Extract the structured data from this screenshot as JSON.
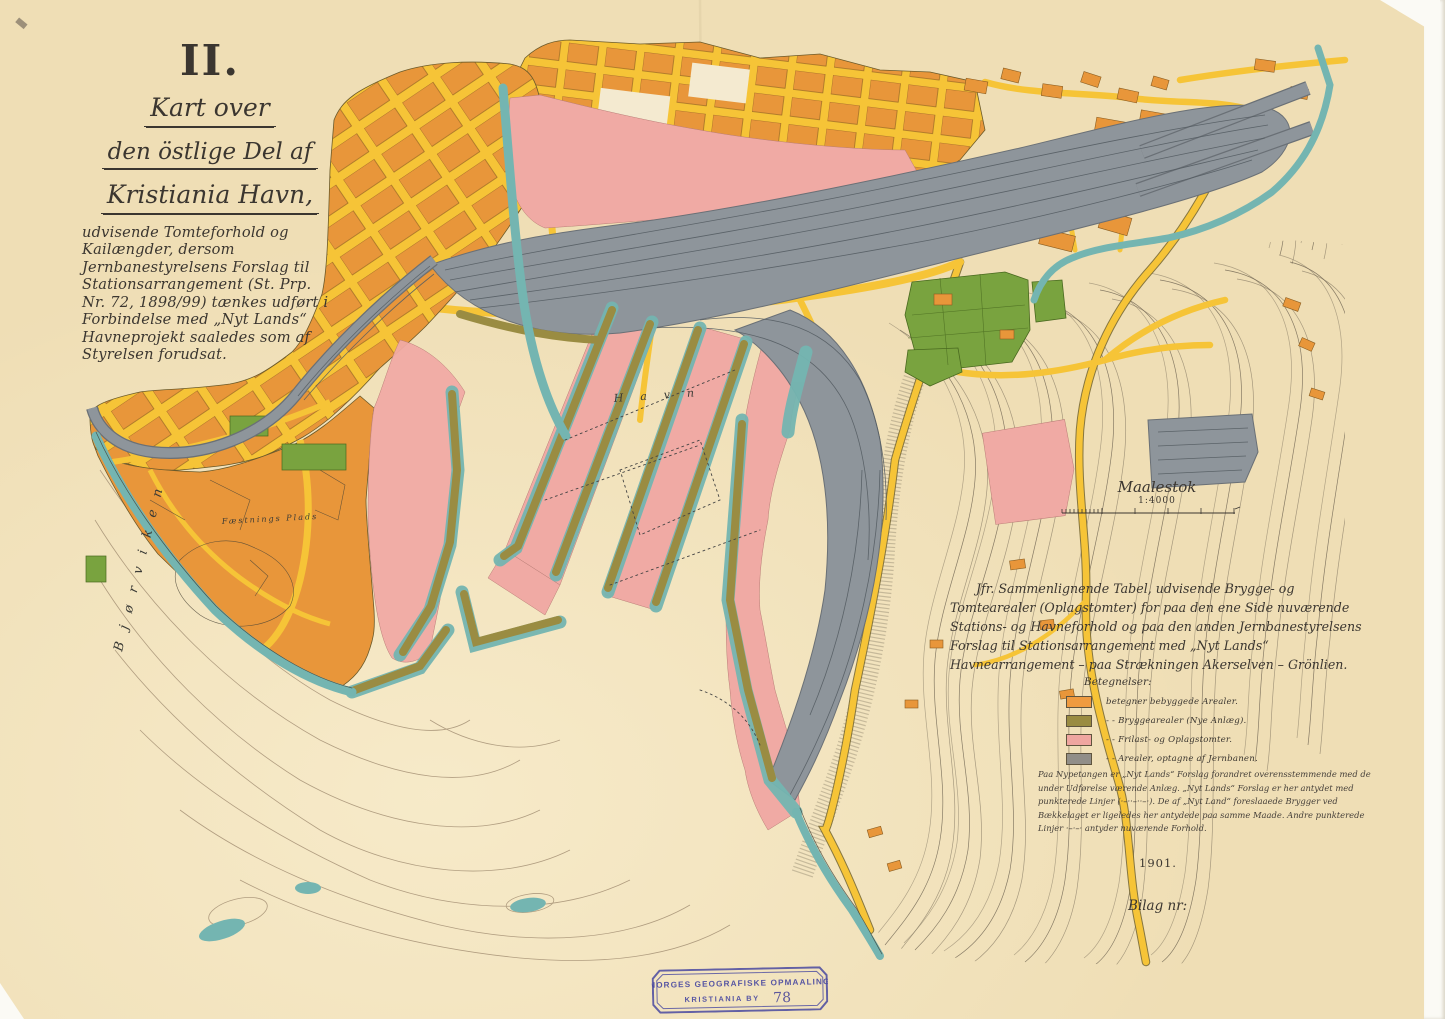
{
  "map": {
    "sheet_numeral": "II.",
    "title": {
      "line1": "Kart over",
      "line2": "den östlige Del af",
      "line3": "Kristiania Havn,",
      "body": "udvisende Tomteforhold og Kailængder, dersom Jernbanestyrelsens Forslag til Stationsarrangement (St. Prp. Nr. 72, 1898/99) tænkes udført i Forbindelse med „Nyt Lands“ Havneprojekt saaledes som af Styrelsen forudsat."
    },
    "scale": {
      "label": "Maalestok",
      "ratio": "1:4000"
    },
    "comparison_note": "Jfr. Sammenlignende Tabel, udvisende Brygge- og Tomtearealer (Oplagstomter) for paa den ene Side nuværende Stations- og Havneforhold og paa den anden Jernbanestyrelsens Forslag til Stationsarrangement med „Nyt Lands“ Havnearrangement – paa Strækningen Akerselven – Grönlien.",
    "legend": {
      "heading": "Betegnelser:",
      "items": [
        {
          "color": "#ef9b40",
          "label": "betegner bebyggede Arealer."
        },
        {
          "color": "#9a8c42",
          "label": "-   -   Bryggearealer (Nye Anlæg)."
        },
        {
          "color": "#efa6a0",
          "label": "-   -   Frilast- og Oplagstomter."
        },
        {
          "color": "#918e88",
          "label": "-   -   Arealer, optagne af Jernbanen."
        }
      ],
      "footnote": "Paa Nypetangen er „Nyt Lands“ Forslag forandret overensstemmende med de under Udførelse værende Anlæg. „Nyt Lands“ Forslag er her antydet med punkterede Linjer (·–··–··–·).  De af „Nyt Land“ foreslaaede Brygger ved Bækkelaget er ligeledes her antydede paa samme Maade.  Andre punkterede Linjer ·–·–· antyder nuværende Forhold."
    },
    "year": "1901.",
    "attachment_label": "Bilag nr:",
    "stamp": {
      "line1": "NORGES GEOGRAFISKE OPMAALING",
      "line2": "KRISTIANIA BY",
      "number": "78"
    },
    "labels": {
      "bay": "Bjørviken",
      "harbor_basin": "Havn",
      "fortress_area": "Fæstnings Plads"
    }
  },
  "colors": {
    "paper": "#f2e2ba",
    "built_area": "#ef9b40",
    "quay_area": "#9a8c42",
    "storage_area": "#efa6a0",
    "railway_area": "#8e959b",
    "water_edge": "#74b5b1",
    "park": "#79a33f",
    "road": "#f6c437",
    "stamp_ink": "#40409a"
  }
}
